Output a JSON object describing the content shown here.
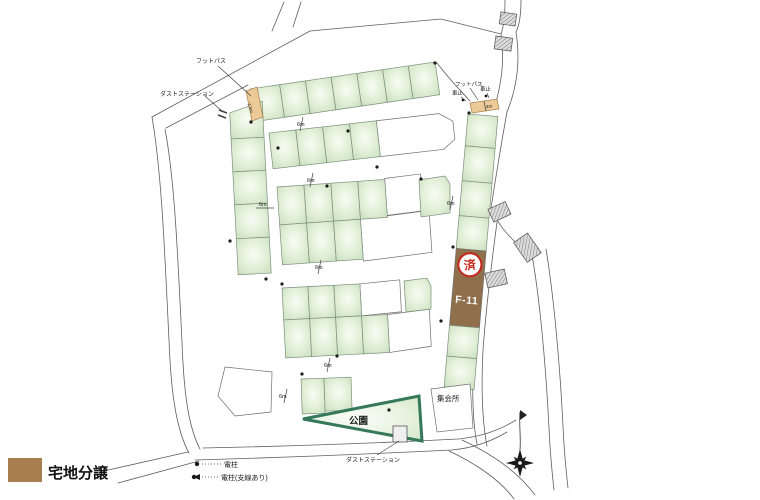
{
  "legend_bottom_left": {
    "label": "宅地分譲",
    "swatch_color": "#a87e4f"
  },
  "map": {
    "labels": {
      "footpath_left": "フットパス",
      "footpath_right": "フットパス",
      "dust_station_top": "ダストステーション",
      "dust_station_bottom": "ダストステーション",
      "car_stop_1": "車止",
      "car_stop_2": "車止",
      "park": "公園",
      "meeting_hall": "集会所"
    },
    "lot": {
      "id": "F-11",
      "stamp": "済",
      "fill": "#8f6f4c",
      "stamp_color": "#c5281c"
    },
    "dimensions": [
      "6m",
      "6m",
      "6m",
      "6m",
      "6m",
      "6m",
      "6m",
      "4m",
      "2.5m"
    ],
    "colors": {
      "plot_green": "#d8e9cd",
      "park_border": "#35785a",
      "footpath_tan": "#ecca97"
    }
  },
  "pole_legend": {
    "items": [
      {
        "label": "電柱"
      },
      {
        "label": "電柱(支線あり)"
      }
    ]
  }
}
